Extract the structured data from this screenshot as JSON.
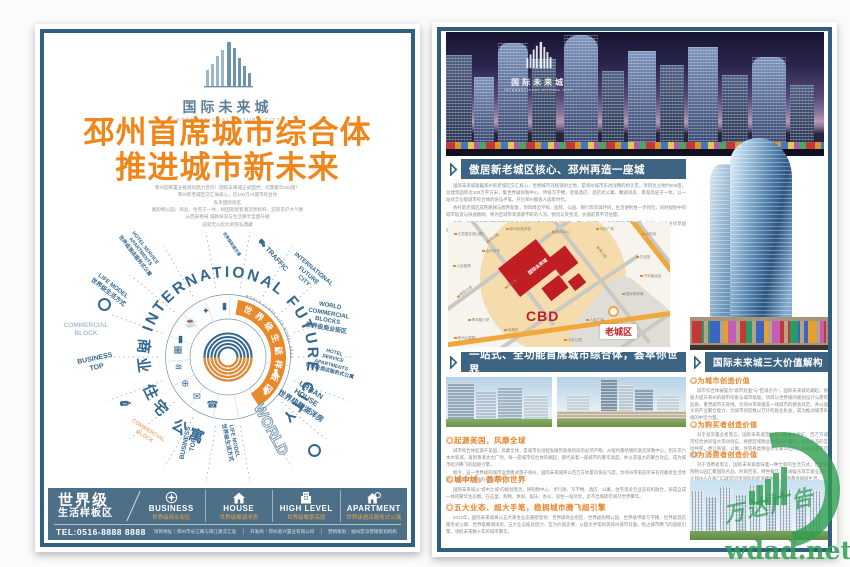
{
  "brand": {
    "cn": "国际未来城",
    "en": "INTERNATIONAL FUTURE CITY"
  },
  "left": {
    "headline1": "邳州首席城市综合体",
    "headline2": "推进城市新未来",
    "intro_lines": [
      "邳州迎来置业投资的鼎力巨作！国际未来城正式面世，问鼎繁华600亩！",
      "邳州新老城区交汇局核心，近100万㎡城市综合体",
      "私享国际街区",
      "集购物公园、商业、住宅于一体，树国际配套潮流新标杆，迎宾京沪大气象",
      "从西安格局 城脉纵深与生活尊享全面升级",
      "成就无以伦比的恢弘典藏"
    ],
    "diagram": {
      "arc_top": "INTERNATIONAL FUTURE CITY",
      "arc_cn": "世界级生活样板区",
      "arc_cn_en": "WORLD CLASS LIFE MODEL AREA",
      "arc_bottom": "商业 住宅 公寓",
      "labels": [
        {
          "t": "HOTEL SERVICE\nAPARTMENTS\n世界级酒店服务式公寓",
          "x": 80,
          "y": 24,
          "r": 52,
          "s": 5,
          "c": "blue"
        },
        {
          "t": "LIFE MODEL\n世界级生活方式",
          "x": 50,
          "y": 62,
          "r": 38,
          "s": 6,
          "c": "blue"
        },
        {
          "t": "COMMERCIAL\nBLOCK",
          "x": 26,
          "y": 102,
          "r": 0,
          "s": 6.5,
          "c": "light"
        },
        {
          "t": "BUSINESS\nTOP",
          "x": 36,
          "y": 136,
          "r": -12,
          "s": 7,
          "c": "blue"
        },
        {
          "t": "✎",
          "x": 66,
          "y": 176,
          "r": -50,
          "s": 13,
          "c": "blue"
        },
        {
          "t": "COMMERCIAL\nBLOCK",
          "x": 86,
          "y": 206,
          "r": 32,
          "s": 5.5,
          "c": "orange"
        },
        {
          "t": "BUSINESS\nTOP",
          "x": 130,
          "y": 216,
          "r": -78,
          "s": 6.5,
          "c": "blue"
        },
        {
          "t": "LIFE MODEL\n世界级生活方式",
          "x": 170,
          "y": 214,
          "r": 78,
          "s": 5.5,
          "c": "blue"
        },
        {
          "t": "WORLD",
          "x": 210,
          "y": 202,
          "r": 62,
          "s": 15,
          "c": "outline"
        },
        {
          "t": "URBAN\nHOUSE\n世界级瞰湖洋房",
          "x": 246,
          "y": 170,
          "r": 33,
          "s": 7.5,
          "c": "blue"
        },
        {
          "t": "HOTEL\nSERVICE\nAPARTMENTS\n世界级酒店服务式公寓",
          "x": 272,
          "y": 134,
          "r": 15,
          "s": 5,
          "c": "blue"
        },
        {
          "t": "WORLD\nCOMMERCIAL BLOCKS\n世界级商业街区",
          "x": 268,
          "y": 90,
          "r": 10,
          "s": 6,
          "c": "blue"
        },
        {
          "t": "INTERNATIONAL\nFUTURE\nCITY",
          "x": 248,
          "y": 48,
          "r": 40,
          "s": 6,
          "c": "blue"
        },
        {
          "t": "⛟ TRAFFIC",
          "x": 212,
          "y": 28,
          "r": 48,
          "s": 7,
          "c": "blue"
        },
        {
          "t": "世界级轨道交通",
          "x": 172,
          "y": 16,
          "r": 55,
          "s": 4,
          "c": "blue"
        }
      ],
      "icons": [
        {
          "g": "▮",
          "a": -160
        },
        {
          "g": "☕",
          "a": -138
        },
        {
          "g": "✦",
          "a": -116
        },
        {
          "g": "▮",
          "a": -94
        },
        {
          "g": "☛",
          "a": -8
        },
        {
          "g": "▮",
          "a": 18
        },
        {
          "g": "▮",
          "a": 42
        },
        {
          "g": "☎",
          "a": 108
        },
        {
          "g": "✉",
          "a": 128
        },
        {
          "g": "⊕",
          "a": 148
        },
        {
          "g": "≋",
          "a": 168
        },
        {
          "g": "▦",
          "a": 188
        }
      ]
    },
    "bar": {
      "grade": "世界级",
      "grade_sub": "生活样板区",
      "items": [
        {
          "en": "BUSINESS",
          "cn": "世界级商业街区",
          "icon": "compass"
        },
        {
          "en": "HOUSE",
          "cn": "世界级瞰湖洋房",
          "icon": "house"
        },
        {
          "en": "HIGH LEVEL",
          "cn": "世界级瞰景高层",
          "icon": "building"
        },
        {
          "en": "APARTMENT",
          "cn": "世界级酒店服务式公寓",
          "icon": "apartment"
        }
      ],
      "tel": "TEL:0516-8888 8888",
      "info": [
        "项目地址｜邳州市长江路与珠江路交汇处",
        "开发商｜邳州富兴置业有限公司",
        "营销策划｜福州宏派营销策划机构"
      ]
    }
  },
  "right": {
    "banner1": "傲居新老城区核心、邳州再造一座城",
    "intro_paras": [
      "国际未来城雄踞邳州新老城区交汇核心，坐拥城市双核辐射之地，是邳州城市东进战略的桥头堡。项目总占地约600亩，总建筑面积近100万平方米，集世界级购物中心、甲级写字楼、星级酒店、酒店式公寓、瞰湖洋房、景观高层于一体，以一站式全功能城市综合体的恢弘手笔，开启邳州都会人居新时代。",
      "依托新老城区成熟路网与醇熟配套，项目周边学校、医院、公园、银行等资源环伺，生活便利性一步到位；同时规划中的城市轨道与快速路网，将为区域带来源源不断的人流、物流与资金流，价值前景不可估量。",
      "未来，这里将汇聚城市最繁华的商业版图与最优越的生活配套，成为引领邳州价值飞跃的城市引擎，让每一位业主尽享国际化的便捷与尊崇，见证一座城市的光荣与梦想。"
    ],
    "map": {
      "project": "国际未来城",
      "cbd": "CBD",
      "old_town": "老城区",
      "pois": [
        {
          "t": "江苏银杏湖公园",
          "x": 6,
          "y": 10
        },
        {
          "t": "邳州实验学校",
          "x": 58,
          "y": 5
        },
        {
          "t": "奥体中心",
          "x": 104,
          "y": 8
        },
        {
          "t": "市民广场",
          "x": 148,
          "y": 5
        },
        {
          "t": "火车站",
          "x": 194,
          "y": 10
        },
        {
          "t": "运河中学",
          "x": 34,
          "y": 27
        },
        {
          "t": "人民医院",
          "x": 5,
          "y": 42
        },
        {
          "t": "文化馆",
          "x": 188,
          "y": 33
        },
        {
          "t": "汽车客运站",
          "x": 192,
          "y": 52
        },
        {
          "t": "银杏大道",
          "x": 8,
          "y": 68,
          "r": -36
        },
        {
          "t": "国际商贸城",
          "x": 174,
          "y": 70
        },
        {
          "t": "青年路小学",
          "x": 20,
          "y": 96
        },
        {
          "t": "市政府",
          "x": 56,
          "y": 106
        },
        {
          "t": "人民广场",
          "x": 138,
          "y": 96
        },
        {
          "t": "邳州大剧院",
          "x": 6,
          "y": 114
        },
        {
          "t": "中央公园",
          "x": 116,
          "y": 116
        },
        {
          "t": "长江路",
          "x": 56,
          "y": 60,
          "r": -36
        },
        {
          "t": "珠江路",
          "x": 146,
          "y": 28,
          "r": 52
        },
        {
          "t": "建设路",
          "x": 38,
          "y": 14,
          "r": -36
        }
      ]
    },
    "banner2": "一站式、全功能首席城市综合体，荟萃你世界",
    "sub1": {
      "title": "◎起源美国，风靡全球",
      "paras": [
        "城市综合体起源于美国，风靡全球，是城市化进程发展到高级阶段的必然产物。从纽约曼哈顿的洛克菲勒中心，到东京六本木新城，再到香港太古广场，每一座城市综合体的崛起，都代表着一座城市的繁华高度，并以其强大的聚合效应，成为城市经济腾飞的超级引擎。",
        "如今，这一世界级的城市运营模式落子邳州，国际未来城将以百万方体量的恢弘气度，为邳州带来前所未有的都会生活体验，推动城市价值的全面跃升。"
      ]
    },
    "sub2": {
      "title": "◎城中城，荟萃你世界",
      "paras": [
        "国际未来城以“城中之城”的规划理念，将购物中心、步行街、写字楼、酒店、公寓、住宅等多元业态有机融合，形成自成一体的繁华生态圈。在这里，购物、休闲、娱乐、办公、居住一站尽享，足不出城即可阅尽世界繁华。"
      ]
    },
    "sub3": {
      "title": "◎五大业态、超大手笔，稳拥城市腾飞超引擎",
      "paras": [
        "2012年，国际未来城将以五大黄金业态重磅登场：世界级商业街区、世界级购物公园、世界级甲级写字楼、世界级酒店服务式公寓、世界级瞰湖洋房。五大业态彼此借力、互为价值支撑，以超大手笔构筑邳州城市封面，抢占城市腾飞的超级引擎，领航未来数十年的城市繁华。"
      ]
    },
    "banner3": "国际未来城三大价值解构",
    "values": [
      {
        "title": "◎为城市创造价值",
        "paras": [
          "城市综合体被誉为“城市封面”与“区域名片”，国际未来城的崛起，将极大提升邳州的城市形象与城市能级。项目以世界级的规划设计与建筑品质，重塑城市天际线，为邳州带来媲美一线城市的都会风范，并以强大的产业聚合能力，为城市创造数以万计的就业机会，成为推动城市升级的中坚力量。"
        ]
      },
      {
        "title": "◎为购买者创造价值",
        "paras": [
          "对于投资置业者而言，国际未来城无疑是一座收益金矿。百万方城市综合体的强大带动效应，将使区域物业价值持续攀升；多元业态的互动共荣，更让商铺、公寓、住宅各类物业尽享繁华红利，升值前景不可限量。"
        ]
      },
      {
        "title": "◎为消费者创造价值",
        "paras": [
          "对于消费者而言，国际未来城意味着一种全新的生活方式。世界级购物公园汇聚国际名品、时尚百货、特色餐饮、休闲娱乐等丰富业态，让邳州人在家门口即可尽享国际化的消费体验，乐享都会缤纷生活。"
        ]
      }
    ]
  },
  "watermark": {
    "brand": "万达广告",
    "url": "wdad.net"
  }
}
